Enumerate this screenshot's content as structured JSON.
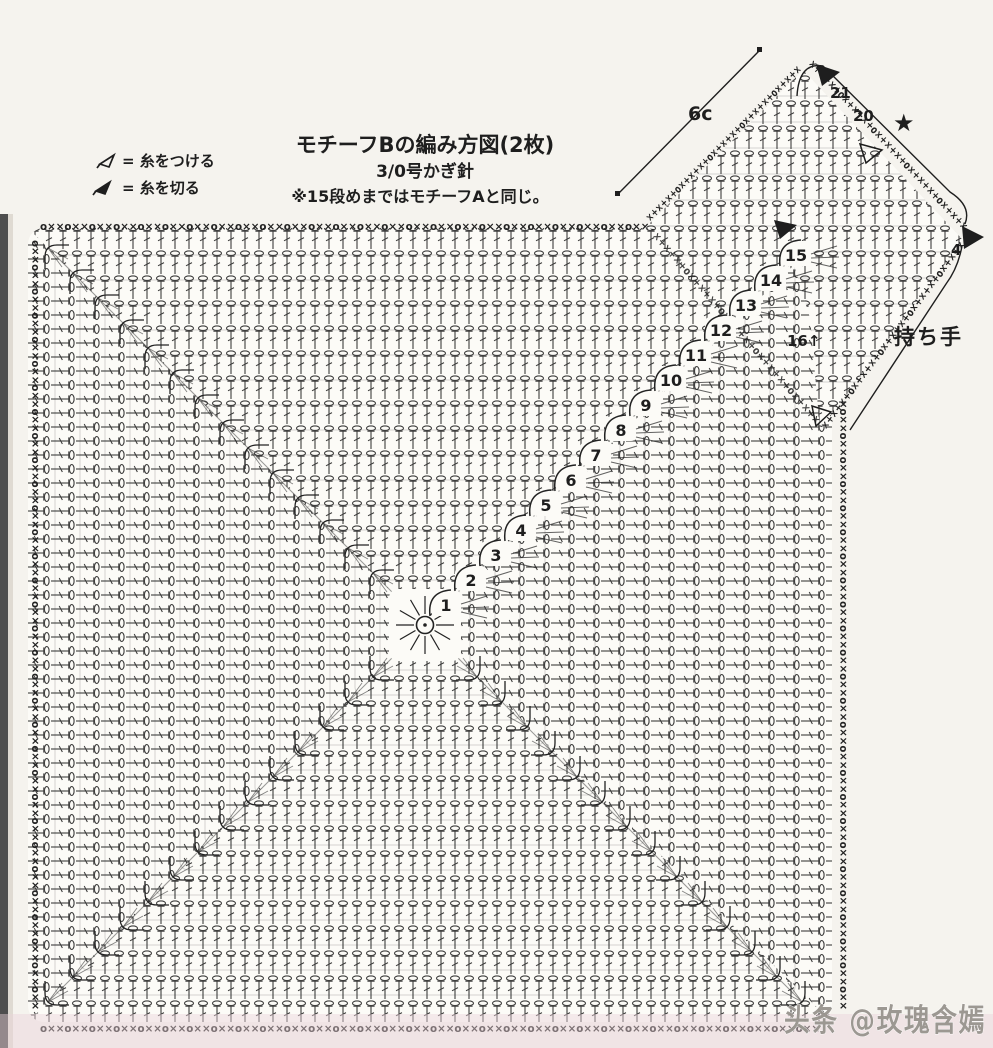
{
  "colors": {
    "paper": "#f5f3ee",
    "chart_bg": "#fcfbf7",
    "ink": "#1e1e1e",
    "watermark_gray": "#98948e",
    "bottom_tint_pink": "#ecd3da"
  },
  "legend": {
    "attach_label": "= 糸をつける",
    "cut_label": "= 糸を切る"
  },
  "header": {
    "title": "モチーフBの編み方図(2枚)",
    "hook": "3/0号かぎ針",
    "note": "※15段めまではモチーフAと同じ。"
  },
  "handle": {
    "label": "持ち手",
    "measurement": "6c",
    "star": "★",
    "row_21": "21",
    "row_20": "20",
    "edge_count": "4"
  },
  "motif": {
    "rounds": [
      "1",
      "2",
      "3",
      "4",
      "5",
      "6",
      "7",
      "8",
      "9",
      "10",
      "11",
      "12",
      "13",
      "14",
      "15"
    ],
    "edge_round": "16↑"
  },
  "edging": {
    "square": "o××o××o××o××o××o××o××o××o××o××o××o××o××o××o××o××o××o××o××o××o××o××o××o××o××o××o××o××o××o××o××o××",
    "handle": "×+×+×+o×+×+×+o×+×+×+o×+×+×+o×+×+×"
  },
  "watermark": "头条 @玫瑰含嫣"
}
